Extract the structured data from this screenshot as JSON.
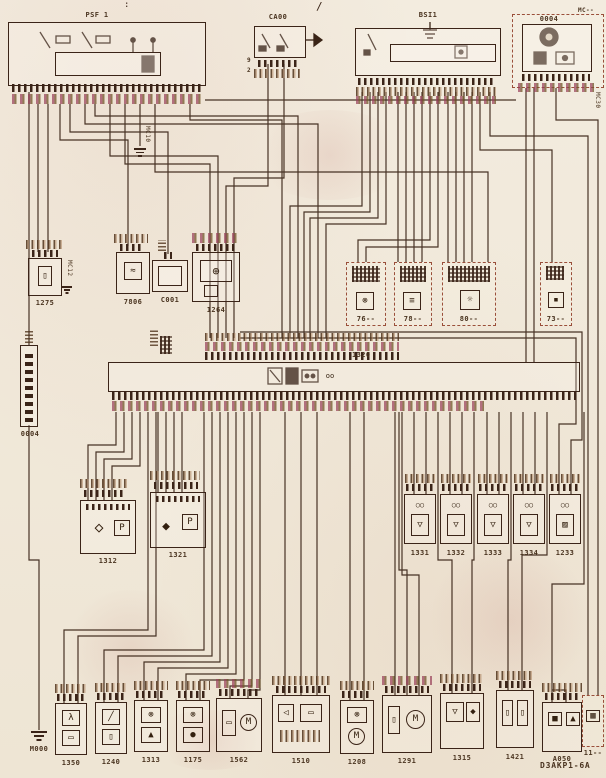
{
  "code": "D3AKP1-6A",
  "marks": {
    "slash": "/",
    "dots": ":"
  },
  "colors": {
    "ink": "#3b2418",
    "paper": "#f2ebdd",
    "dash_red": "#9a4f3a",
    "pink_fleck": "#c06a7a",
    "olive_fleck": "#7a6a2f"
  },
  "top": {
    "psf1": {
      "label": "PSF 1"
    },
    "ca00": {
      "label": "CA00",
      "pin_tags": [
        "9",
        "2"
      ]
    },
    "bsi": {
      "label": "BSI1"
    },
    "cluster": {
      "label": "0004",
      "corner_tag": "MC--",
      "side_tag": "MC30"
    }
  },
  "left_rail": {
    "connector_label": "0004",
    "ground_label": "M000"
  },
  "mid": {
    "c1275": {
      "label": "1275",
      "tag": "MC12",
      "glyph": "▯"
    },
    "c7806": {
      "label": "7806",
      "glyph": "≈"
    },
    "c001": {
      "label": "C001"
    },
    "c1264": {
      "label": "1264",
      "glyph": "⊕"
    },
    "tag_mc10": "MC10",
    "dashed": [
      {
        "label": "76--",
        "glyph": "⊗"
      },
      {
        "label": "78--",
        "glyph": "≡"
      },
      {
        "label": "80--",
        "glyph": "☼"
      },
      {
        "label": "73--",
        "glyph": "▪"
      }
    ]
  },
  "ecu": {
    "label": "1320",
    "glyph": "oo"
  },
  "pressure_sensors": [
    {
      "label": "1312",
      "glyph": "◇",
      "symbol": "P"
    },
    {
      "label": "1321",
      "glyph": "◆",
      "symbol": "P"
    }
  ],
  "injectors": {
    "valve_glyph": "○○",
    "items": [
      {
        "label": "1331",
        "glyph": "▽"
      },
      {
        "label": "1332",
        "glyph": "▽"
      },
      {
        "label": "1333",
        "glyph": "▽"
      },
      {
        "label": "1334",
        "glyph": "▽"
      },
      {
        "label": "1233",
        "glyph": "▨"
      }
    ]
  },
  "bottom": [
    {
      "label": "1350",
      "icons": [
        "λ",
        "▭"
      ]
    },
    {
      "label": "1240",
      "icons": [
        "╱",
        "▯"
      ]
    },
    {
      "label": "1313",
      "icons": [
        "⊗",
        "▲"
      ]
    },
    {
      "label": "1175",
      "icons": [
        "⊗",
        "●"
      ]
    },
    {
      "label": "1562",
      "icons": [
        "▭",
        "M"
      ]
    },
    {
      "label": "1510",
      "icons": [
        "◁",
        "▭"
      ]
    },
    {
      "label": "1208",
      "icons": [
        "⊗",
        "M"
      ]
    },
    {
      "label": "1291",
      "icons": [
        "▯",
        "M"
      ]
    },
    {
      "label": "1315",
      "icons": [
        "▽",
        "◆"
      ]
    },
    {
      "label": "1421",
      "icons": [
        "▯",
        "▯"
      ]
    },
    {
      "label": "A050",
      "icons": [
        "■",
        "▲"
      ]
    },
    {
      "label": "11--",
      "icons": [
        "▦"
      ]
    }
  ]
}
